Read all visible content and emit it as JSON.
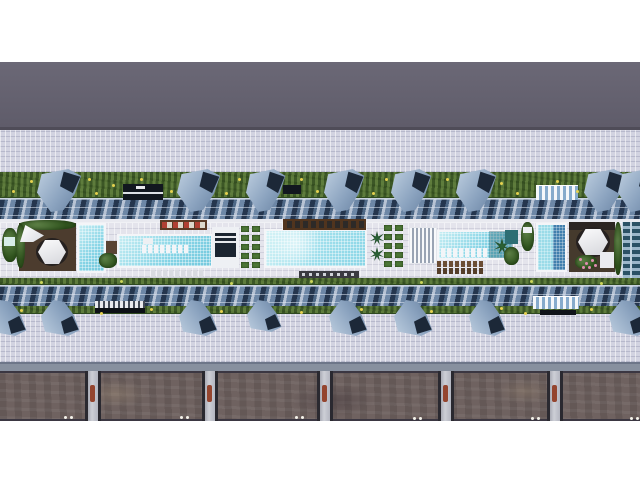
{
  "scene": {
    "description": "Aerial 3D architectural rendering of a linear resort podium: central pool deck with lap pools, cabanas and planters, flanked by sawtooth glass roofs, lawn strips with blue shade canopies, tiled plazas, and a stone retaining wall with pillars along the bottom roadway.",
    "palette": {
      "canopy_blue": "#8ba3bf",
      "canopy_shadow": "#1c2838",
      "pool_water": "#84d3e5",
      "deep_water": "#417fae",
      "grass": "#516f35",
      "plaza_tile": "#d2d3e1",
      "deck_tile": "#e4e4ec",
      "upper_roadway": "#676472",
      "stone_wall": "#6f6260",
      "wood_deck": "#4c3c2e",
      "accent_red": "#b04034",
      "flower_yellow": "#e5d14f",
      "flower_pink": "#e08cb0"
    },
    "bands": [
      {
        "name": "sky-strip",
        "y": 0,
        "h": 62,
        "bg": "#ffffff"
      },
      {
        "name": "upper-roadway",
        "y": 62,
        "h": 65,
        "bg": "linear-gradient(180deg,#6b6876,#5f5c6a)"
      },
      {
        "name": "upper-roadway-edge",
        "y": 127,
        "h": 3,
        "bg": "#4f4c58"
      },
      {
        "name": "upper-plaza",
        "y": 130,
        "h": 42,
        "cls": "tiles"
      },
      {
        "name": "upper-lawn",
        "y": 172,
        "h": 27,
        "cls": "grass"
      },
      {
        "name": "upper-glass-roof",
        "y": 198,
        "h": 22,
        "cls": "glass"
      },
      {
        "name": "deck-parapet",
        "y": 219,
        "h": 4,
        "bg": "#e9eaf0"
      },
      {
        "name": "pool-deck",
        "y": 222,
        "h": 56,
        "cls": "deck"
      },
      {
        "name": "deck-hedge-south",
        "y": 278,
        "h": 8,
        "cls": "grass"
      },
      {
        "name": "lower-glass-roof",
        "y": 285,
        "h": 22,
        "cls": "glass"
      },
      {
        "name": "lower-hedge",
        "y": 306,
        "h": 9,
        "cls": "grass"
      },
      {
        "name": "lower-plaza",
        "y": 314,
        "h": 48,
        "cls": "tiles"
      },
      {
        "name": "service-road",
        "y": 362,
        "h": 9,
        "bg": "linear-gradient(180deg,#6d7689 0 2px,#87909f 2px)"
      },
      {
        "name": "stone-wall-band",
        "y": 371,
        "h": 50,
        "cls": "stone"
      },
      {
        "name": "bottom-strip",
        "y": 421,
        "h": 59,
        "bg": "#ffffff"
      }
    ],
    "elements": [
      {
        "t": "rect",
        "name": "planter-left",
        "cls": "bush",
        "x": 2,
        "y": 228,
        "w": 16,
        "h": 34
      },
      {
        "t": "rect",
        "name": "bench-left",
        "x": 4,
        "y": 237,
        "w": 11,
        "h": 9,
        "bg": "#d7ece8"
      },
      {
        "t": "rect",
        "name": "vip-deck-left",
        "x": 19,
        "y": 223,
        "w": 57,
        "h": 48,
        "bg": "#4c3c2e"
      },
      {
        "t": "rect",
        "name": "vip-hedge-top",
        "cls": "bush",
        "x": 19,
        "y": 220,
        "w": 57,
        "h": 10
      },
      {
        "t": "rect",
        "name": "vip-hedge-left",
        "cls": "bush",
        "x": 16,
        "y": 224,
        "w": 9,
        "h": 44
      },
      {
        "t": "rect",
        "name": "shade-sail",
        "cls": "sail",
        "x": 20,
        "y": 225,
        "w": 24,
        "h": 17
      },
      {
        "t": "hex",
        "name": "cabana-left",
        "x": 38,
        "y": 240,
        "w": 28,
        "h": 24
      },
      {
        "t": "pool",
        "name": "plunge-pool",
        "water": "lightA",
        "x": 77,
        "y": 223,
        "w": 29,
        "h": 50
      },
      {
        "t": "rect",
        "name": "deck-bar-left",
        "x": 106,
        "y": 241,
        "w": 13,
        "h": 13,
        "bg": "#5a4434"
      },
      {
        "t": "rect",
        "name": "bush-a",
        "cls": "bush",
        "x": 99,
        "y": 253,
        "w": 18,
        "h": 15
      },
      {
        "t": "pool",
        "name": "lap-pool",
        "water": "lightA",
        "x": 117,
        "y": 234,
        "w": 96,
        "h": 34
      },
      {
        "t": "rect",
        "name": "swimup-island",
        "x": 143,
        "y": 238,
        "w": 10,
        "h": 6,
        "bg": "#eef0f3"
      },
      {
        "t": "row",
        "name": "lap-pool-inwater-loungers",
        "x": 142,
        "y": 245,
        "n": 8,
        "dx": 6,
        "w": 4,
        "h": 8,
        "c": "#f3f5f8"
      },
      {
        "t": "row",
        "name": "lap-pool-loungers",
        "x": 151,
        "y": 270,
        "n": 9,
        "dx": 6,
        "w": 4,
        "h": 7,
        "c": "#d9dbe1"
      },
      {
        "t": "rect",
        "name": "sunbed-bar-west",
        "x": 160,
        "y": 220,
        "w": 47,
        "h": 10,
        "bg": "#5a3a26"
      },
      {
        "t": "row",
        "name": "sunbed-row-red",
        "x": 162,
        "y": 222,
        "n": 4,
        "dx": 11,
        "w": 5,
        "h": 6,
        "c": "#b04034"
      },
      {
        "t": "row",
        "name": "sunbed-row-white",
        "x": 167,
        "y": 222,
        "n": 4,
        "dx": 11,
        "w": 5,
        "h": 6,
        "c": "#ddd8cc"
      },
      {
        "t": "rect",
        "name": "pool-pavilion",
        "x": 212,
        "y": 227,
        "w": 27,
        "h": 41,
        "bg": "#eef0f4"
      },
      {
        "t": "rect",
        "name": "pool-pavilion-roof",
        "x": 215,
        "y": 233,
        "w": 21,
        "h": 24,
        "bg": "#1b2430"
      },
      {
        "t": "rect",
        "name": "pool-pavilion-stripe-1",
        "x": 215,
        "y": 236,
        "w": 21,
        "h": 2,
        "bg": "#e6e8ec"
      },
      {
        "t": "rect",
        "name": "pool-pavilion-stripe-2",
        "x": 215,
        "y": 241,
        "w": 21,
        "h": 2,
        "bg": "#e6e8ec"
      },
      {
        "t": "grid",
        "name": "planter-grid-west",
        "x": 241,
        "y": 226,
        "cols": 2,
        "rows": 5,
        "cw": 8,
        "ch": 6,
        "gx": 3,
        "gy": 3,
        "c": "#4d7737"
      },
      {
        "t": "pool",
        "name": "main-pool",
        "water": "lightB",
        "x": 264,
        "y": 229,
        "w": 103,
        "h": 39
      },
      {
        "t": "rect",
        "name": "sunbed-bar-center",
        "x": 283,
        "y": 219,
        "w": 83,
        "h": 11,
        "bg": "#50341e"
      },
      {
        "t": "row",
        "name": "sunbed-row-center",
        "x": 287,
        "y": 221,
        "n": 10,
        "dx": 8,
        "w": 5,
        "h": 7,
        "c": "#2d2a28"
      },
      {
        "t": "rect",
        "name": "lounger-strip-center",
        "x": 299,
        "y": 271,
        "w": 60,
        "h": 7,
        "bg": "#3a3a41"
      },
      {
        "t": "row",
        "name": "lounger-strip-center-cushions",
        "x": 302,
        "y": 273,
        "n": 8,
        "dx": 7,
        "w": 3,
        "h": 3,
        "c": "#cfd2d8"
      },
      {
        "t": "palm",
        "name": "palm-a",
        "x": 370,
        "y": 231,
        "s": 14
      },
      {
        "t": "palm",
        "name": "palm-b",
        "x": 370,
        "y": 247,
        "s": 14
      },
      {
        "t": "grid",
        "name": "planter-grid-east",
        "x": 384,
        "y": 225,
        "cols": 2,
        "rows": 5,
        "cw": 8,
        "ch": 6,
        "gx": 3,
        "gy": 3,
        "c": "#4d7737"
      },
      {
        "t": "rect",
        "name": "slat-pavilion",
        "cls": "slats",
        "x": 409,
        "y": 227,
        "w": 28,
        "h": 37
      },
      {
        "t": "pool",
        "name": "family-pool",
        "water": "lightA",
        "x": 437,
        "y": 230,
        "w": 77,
        "h": 30
      },
      {
        "t": "row",
        "name": "family-inwater-loungers",
        "x": 441,
        "y": 248,
        "n": 8,
        "dx": 6,
        "w": 4,
        "h": 9,
        "c": "#f3f5f8"
      },
      {
        "t": "rect",
        "name": "palm-shadow",
        "x": 489,
        "y": 231,
        "w": 24,
        "h": 27,
        "bg": "rgba(23,84,96,0.35)"
      },
      {
        "t": "palm",
        "name": "palm-c",
        "x": 494,
        "y": 238,
        "s": 16
      },
      {
        "t": "rect",
        "name": "spa-block",
        "x": 505,
        "y": 230,
        "w": 13,
        "h": 14,
        "bg": "#2e6e74"
      },
      {
        "t": "rect",
        "name": "bush-east",
        "cls": "bush",
        "x": 504,
        "y": 247,
        "w": 15,
        "h": 18
      },
      {
        "t": "row",
        "name": "family-loungers-row-1",
        "x": 437,
        "y": 261,
        "n": 8,
        "dx": 6,
        "w": 4,
        "h": 6,
        "c": "#6b4d35"
      },
      {
        "t": "row",
        "name": "family-loungers-row-2",
        "x": 437,
        "y": 268,
        "n": 8,
        "dx": 6,
        "w": 4,
        "h": 6,
        "c": "#553e2a"
      },
      {
        "t": "rect",
        "name": "planter-bench-right",
        "cls": "bush",
        "x": 521,
        "y": 222,
        "w": 13,
        "h": 29
      },
      {
        "t": "rect",
        "name": "bench-right",
        "x": 523,
        "y": 227,
        "w": 9,
        "h": 6,
        "bg": "#eef0f3"
      },
      {
        "t": "pool",
        "name": "deep-pool",
        "water": "split",
        "x": 536,
        "y": 223,
        "w": 31,
        "h": 49
      },
      {
        "t": "rect",
        "name": "vip-deck-right",
        "x": 569,
        "y": 222,
        "w": 46,
        "h": 50,
        "bg": "#453a2d"
      },
      {
        "t": "rect",
        "name": "vip-deck-right-edge",
        "x": 569,
        "y": 222,
        "w": 46,
        "h": 8,
        "bg": "#2b2522"
      },
      {
        "t": "hex",
        "name": "cabana-right",
        "x": 578,
        "y": 229,
        "w": 30,
        "h": 26
      },
      {
        "t": "rect",
        "name": "flower-bed-right",
        "cls": "bush",
        "x": 575,
        "y": 255,
        "w": 22,
        "h": 14
      },
      {
        "t": "dots",
        "name": "flower-dots-pink",
        "c": "#e08cb0",
        "r": 1.5,
        "pts": [
          [
            579,
            258
          ],
          [
            585,
            262
          ],
          [
            591,
            259
          ],
          [
            588,
            266
          ],
          [
            582,
            266
          ],
          [
            594,
            264
          ]
        ]
      },
      {
        "t": "rect",
        "name": "lounge-sofa-right",
        "x": 600,
        "y": 252,
        "w": 14,
        "h": 16,
        "bg": "#e9eaef"
      },
      {
        "t": "rect",
        "name": "hedge-right",
        "cls": "bush",
        "x": 614,
        "y": 222,
        "w": 8,
        "h": 53
      },
      {
        "t": "rect",
        "name": "tower-facade",
        "cls": "facade",
        "x": 622,
        "y": 222,
        "w": 18,
        "h": 56
      },
      {
        "t": "rect",
        "name": "pergola-dark-north",
        "x": 123,
        "y": 184,
        "w": 40,
        "h": 16,
        "bg": "#12171f"
      },
      {
        "t": "rect",
        "name": "pergola-dark-north-stripe",
        "x": 123,
        "y": 192,
        "w": 40,
        "h": 2,
        "bg": "#dde0e5"
      },
      {
        "t": "rect",
        "name": "pergola-dark-north-table",
        "x": 136,
        "y": 186,
        "w": 9,
        "h": 3,
        "bg": "#e8e9ec"
      },
      {
        "t": "rect",
        "name": "pergola-dark-north-b",
        "x": 283,
        "y": 185,
        "w": 18,
        "h": 9,
        "bg": "#12171f"
      },
      {
        "t": "rect",
        "name": "pergola-striped-north",
        "cls": "stripes",
        "x": 536,
        "y": 185,
        "w": 42,
        "h": 15
      },
      {
        "t": "dots",
        "name": "lawn-flowers-north",
        "c": "#e5d14f",
        "r": 1.5,
        "pts": [
          [
            12,
            190
          ],
          [
            30,
            180
          ],
          [
            52,
            193
          ],
          [
            88,
            178
          ],
          [
            95,
            192
          ],
          [
            112,
            184
          ],
          [
            140,
            178
          ],
          [
            170,
            190
          ],
          [
            200,
            180
          ],
          [
            225,
            192
          ],
          [
            238,
            178
          ],
          [
            262,
            186
          ],
          [
            300,
            178
          ],
          [
            316,
            190
          ],
          [
            352,
            180
          ],
          [
            372,
            192
          ],
          [
            385,
            178
          ],
          [
            420,
            186
          ],
          [
            446,
            178
          ],
          [
            470,
            190
          ],
          [
            500,
            182
          ],
          [
            516,
            192
          ],
          [
            556,
            180
          ],
          [
            576,
            190
          ],
          [
            600,
            178
          ],
          [
            630,
            188
          ]
        ]
      },
      {
        "t": "rect",
        "name": "sunken-lounge-strip",
        "cls": "ticks",
        "x": 95,
        "y": 301,
        "w": 50,
        "h": 8
      },
      {
        "t": "rect",
        "name": "sunken-lounge-bar",
        "x": 95,
        "y": 308,
        "w": 50,
        "h": 5,
        "bg": "#0d1116"
      },
      {
        "t": "rect",
        "name": "pergola-striped-south",
        "cls": "stripes",
        "x": 533,
        "y": 296,
        "w": 46,
        "h": 13
      },
      {
        "t": "rect",
        "name": "pergola-south-bar",
        "x": 540,
        "y": 310,
        "w": 36,
        "h": 5,
        "bg": "#10141a"
      },
      {
        "t": "dots",
        "name": "hedge-flowers-mid",
        "c": "#cbd55a",
        "r": 1.5,
        "pts": [
          [
            40,
            281
          ],
          [
            120,
            280
          ],
          [
            230,
            282
          ],
          [
            310,
            280
          ],
          [
            420,
            281
          ],
          [
            530,
            280
          ],
          [
            600,
            282
          ]
        ]
      },
      {
        "t": "dots",
        "name": "hedge-flowers-south",
        "c": "#e5d14f",
        "r": 1.5,
        "pts": [
          [
            20,
            309
          ],
          [
            60,
            307
          ],
          [
            100,
            312
          ],
          [
            150,
            308
          ],
          [
            220,
            310
          ],
          [
            262,
            307
          ],
          [
            300,
            311
          ],
          [
            360,
            308
          ],
          [
            430,
            310
          ],
          [
            500,
            307
          ],
          [
            524,
            312
          ],
          [
            590,
            308
          ],
          [
            624,
            310
          ]
        ]
      },
      {
        "t": "pillar",
        "name": "wall-pillar-1",
        "x": 88,
        "y": 371,
        "w": 10,
        "h": 50
      },
      {
        "t": "pillar",
        "name": "wall-pillar-2",
        "x": 205,
        "y": 371,
        "w": 10,
        "h": 50
      },
      {
        "t": "pillar",
        "name": "wall-pillar-3",
        "x": 320,
        "y": 371,
        "w": 10,
        "h": 50
      },
      {
        "t": "pillar",
        "name": "wall-pillar-4",
        "x": 441,
        "y": 371,
        "w": 10,
        "h": 50
      },
      {
        "t": "pillar",
        "name": "wall-pillar-5",
        "x": 550,
        "y": 371,
        "w": 10,
        "h": 50
      },
      {
        "t": "dots",
        "name": "wall-lights",
        "c": "#f5f2ea",
        "r": 1.5,
        "pts": [
          [
            64,
            416
          ],
          [
            70,
            416
          ],
          [
            180,
            416
          ],
          [
            186,
            416
          ],
          [
            295,
            416
          ],
          [
            301,
            416
          ],
          [
            413,
            417
          ],
          [
            419,
            417
          ],
          [
            531,
            417
          ],
          [
            537,
            417
          ],
          [
            630,
            417
          ],
          [
            636,
            417
          ]
        ]
      }
    ],
    "canopies": {
      "north": {
        "y": 169,
        "h": 43,
        "items": [
          {
            "x": 37,
            "w": 46
          },
          {
            "x": 177,
            "w": 45
          },
          {
            "x": 246,
            "w": 41
          },
          {
            "x": 324,
            "w": 42
          },
          {
            "x": 391,
            "w": 42
          },
          {
            "x": 456,
            "w": 42
          },
          {
            "x": 584,
            "w": 44
          },
          {
            "x": 618,
            "w": 42
          }
        ]
      },
      "south": {
        "y": 300,
        "h": 36,
        "items": [
          {
            "x": -12,
            "w": 40
          },
          {
            "x": 41,
            "w": 40
          },
          {
            "x": 179,
            "w": 40
          },
          {
            "x": 247,
            "w": 36,
            "h": 32
          },
          {
            "x": 329,
            "w": 40
          },
          {
            "x": 394,
            "w": 40
          },
          {
            "x": 469,
            "w": 38
          },
          {
            "x": 609,
            "w": 42
          }
        ]
      }
    }
  }
}
